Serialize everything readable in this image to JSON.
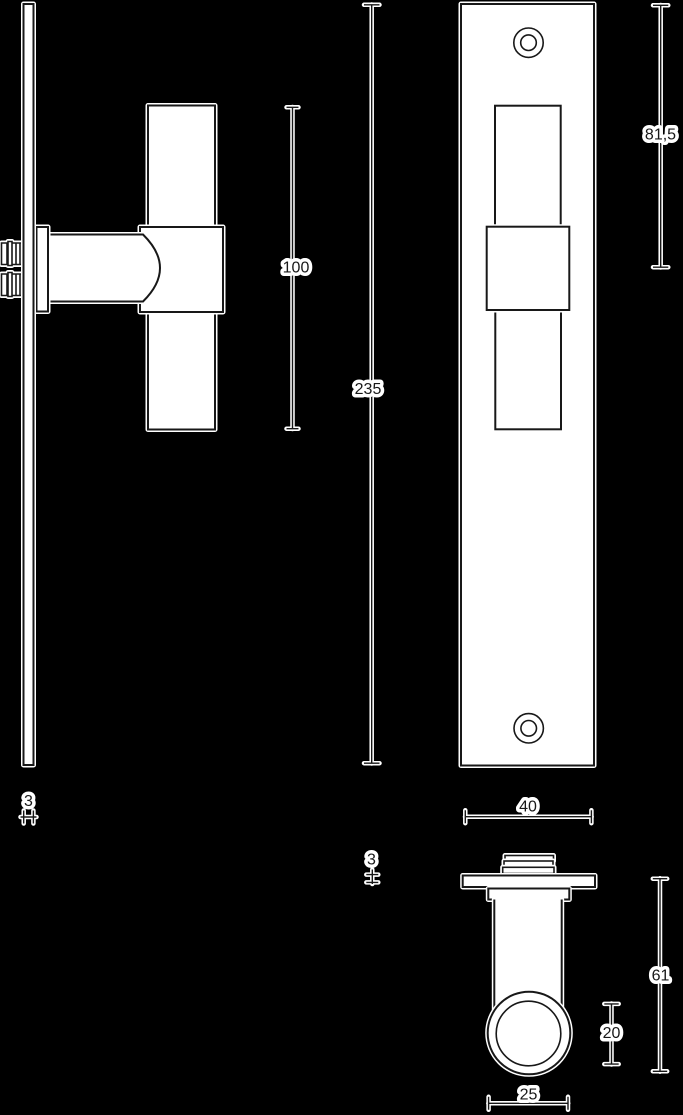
{
  "colors": {
    "background": "#000000",
    "ink": "#181818",
    "shape_fill": "#ffffff",
    "halo": "#ffffff"
  },
  "dimensions": {
    "grip_length": "100",
    "plate_length": "235",
    "handle_center_from_top": "81,5",
    "plate_thickness_side": "3",
    "plate_width": "40",
    "plate_thickness_bottom": "3",
    "handle_projection": "61",
    "neck_diameter": "20",
    "grip_diameter": "25"
  }
}
